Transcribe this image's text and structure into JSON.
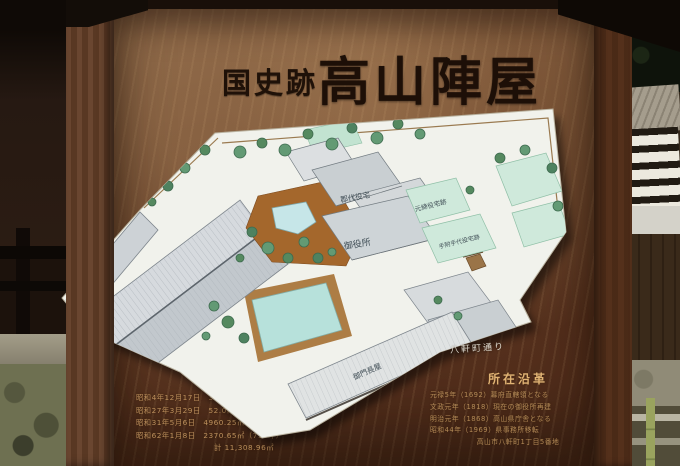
{
  "sign": {
    "prefix": "国史跡",
    "title": "高山陣屋"
  },
  "map": {
    "labels": {
      "gundai": "郡代役宅",
      "oyakusho": "御役所",
      "motojime": "元締役宅跡",
      "tetsuke": "手附手代役宅跡",
      "nagaya": "御門長屋",
      "street": "八軒町通り"
    }
  },
  "info_left": {
    "heading": "国史跡指定",
    "lines": [
      "昭和4年12月17日　3926.06㎡（1,190坪）",
      "昭和27年3月29日　52.0㎡（16坪）追加",
      "昭和31年5月6日　4960.25㎡（1,504坪）",
      "昭和62年1月8日　2370.65㎡（718坪）",
      "計 11,308.96㎡"
    ]
  },
  "info_right": {
    "heading": "所在沿革",
    "lines": [
      "元禄5年（1692）幕府直轄領となる",
      "文政元年（1818）現在の御役所再建",
      "明治元年（1868）高山県庁舎となる",
      "昭和44年（1969）県事務所移転",
      "高山市八軒町1丁目5番地"
    ]
  },
  "colors": {
    "board_wood": "#5d3b24",
    "frame_wood": "#4a2b18",
    "map_paper": "#f1f2ec",
    "roof_gray": "#ccd2d6",
    "plot_green": "#cfe9db",
    "pond_cyan": "#c6e6e8",
    "garden_brown": "#a4672c",
    "courtyard_cyan": "#b7e1db",
    "title_ink": "#1d0f07",
    "painted_text": "#cfa068",
    "caption_white": "#eae6dc"
  }
}
